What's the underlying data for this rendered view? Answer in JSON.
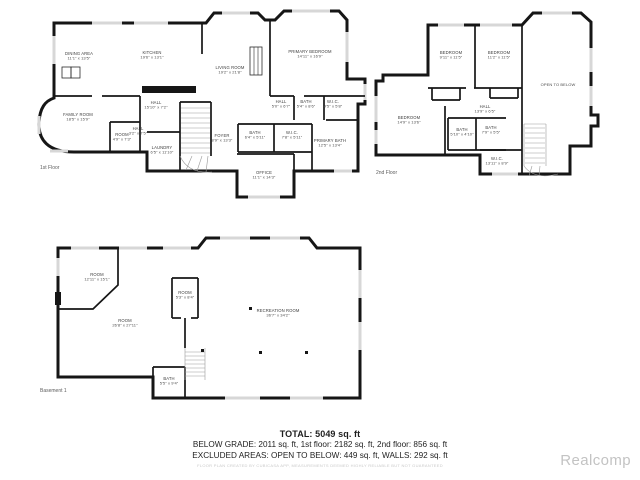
{
  "watermark": "Realcomp",
  "footer": {
    "total": "TOTAL: 5049 sq. ft",
    "area_breakdown": "BELOW GRADE: 2011 sq. ft, 1st floor: 2182 sq. ft, 2nd floor: 856 sq. ft",
    "excluded": "EXCLUDED AREAS: OPEN TO BELOW: 449 sq. ft, WALLS: 292 sq. ft",
    "disclaimer": "FLOOR PLAN CREATED BY CUBICASA APP, MEASUREMENTS DEEMED HIGHLY RELIABLE BUT NOT GUARANTEED"
  },
  "colors": {
    "wall": "#161616",
    "window": "#d7d7d7",
    "label_text": "#3d3d3d",
    "footer_text": "#1f1f1f",
    "watermark": "#c3c3c3"
  },
  "floors": [
    {
      "id": "floor-1",
      "caption": "1st Floor",
      "rooms": [
        {
          "name": "DINING AREA",
          "dims": "11'1\" x 13'5\"",
          "x": 45,
          "y": 51
        },
        {
          "name": "KITCHEN",
          "dims": "19'6\" x 13'1\"",
          "x": 118,
          "y": 50
        },
        {
          "name": "LIVING ROOM",
          "dims": "19'2\" x 21'8\"",
          "x": 196,
          "y": 65
        },
        {
          "name": "PRIMARY BEDROOM",
          "dims": "14'11\" x 16'9\"",
          "x": 276,
          "y": 49
        },
        {
          "name": "FAMILY ROOM",
          "dims": "18'5\" x 15'9\"",
          "x": 44,
          "y": 112
        },
        {
          "name": "HALL",
          "dims": "15'10\" x 7'2\"",
          "x": 122,
          "y": 100
        },
        {
          "name": "HALL",
          "dims": "3'2\" x 7'5\"",
          "x": 104,
          "y": 126
        },
        {
          "name": "ROOM",
          "dims": "4'9\" x 7'3\"",
          "x": 88,
          "y": 132
        },
        {
          "name": "LAUNDRY",
          "dims": "6'5\" x 11'10\"",
          "x": 128,
          "y": 145
        },
        {
          "name": "FOYER",
          "dims": "8'9\" x 13'3\"",
          "x": 188,
          "y": 133
        },
        {
          "name": "HALL",
          "dims": "5'0\" x 6'7\"",
          "x": 247,
          "y": 99
        },
        {
          "name": "BATH",
          "dims": "5'4\" x 8'6\"",
          "x": 272,
          "y": 99
        },
        {
          "name": "W.I.C.",
          "dims": "4'5\" x 5'8\"",
          "x": 299,
          "y": 99
        },
        {
          "name": "BATH",
          "dims": "6'4\" x 5'11\"",
          "x": 221,
          "y": 130
        },
        {
          "name": "W.I.C.",
          "dims": "7'8\" x 5'11\"",
          "x": 258,
          "y": 130
        },
        {
          "name": "PRIMARY BATH",
          "dims": "12'5\" x 13'4\"",
          "x": 296,
          "y": 138
        },
        {
          "name": "OFFICE",
          "dims": "11'1\" x 14'3\"",
          "x": 230,
          "y": 170
        }
      ]
    },
    {
      "id": "floor-2",
      "caption": "2nd Floor",
      "rooms": [
        {
          "name": "BEDROOM",
          "dims": "9'11\" x 11'5\"",
          "x": 79,
          "y": 50
        },
        {
          "name": "BEDROOM",
          "dims": "11'2\" x 11'5\"",
          "x": 127,
          "y": 50
        },
        {
          "name": "OPEN TO BELOW",
          "dims": "",
          "x": 186,
          "y": 82
        },
        {
          "name": "BEDROOM",
          "dims": "14'9\" x 13'6\"",
          "x": 37,
          "y": 115
        },
        {
          "name": "HALL",
          "dims": "13'9\" x 6'5\"",
          "x": 113,
          "y": 104
        },
        {
          "name": "BATH",
          "dims": "5'10\" x 4'10\"",
          "x": 90,
          "y": 127
        },
        {
          "name": "BATH",
          "dims": "7'9\" x 5'5\"",
          "x": 119,
          "y": 125
        },
        {
          "name": "W.I.C.",
          "dims": "13'11\" x 8'9\"",
          "x": 125,
          "y": 156
        }
      ]
    },
    {
      "id": "floor-b",
      "caption": "Basement 1",
      "rooms": [
        {
          "name": "ROOM",
          "dims": "12'11\" x 15'1\"",
          "x": 42,
          "y": 46
        },
        {
          "name": "ROOM",
          "dims": "26'8\" x 27'11\"",
          "x": 70,
          "y": 92
        },
        {
          "name": "ROOM",
          "dims": "5'3\" x 8'4\"",
          "x": 130,
          "y": 64
        },
        {
          "name": "RECREATION ROOM",
          "dims": "36'7\" x 34'2\"",
          "x": 223,
          "y": 82
        },
        {
          "name": "BATH",
          "dims": "5'5\" x 9'4\"",
          "x": 114,
          "y": 150
        }
      ]
    }
  ]
}
